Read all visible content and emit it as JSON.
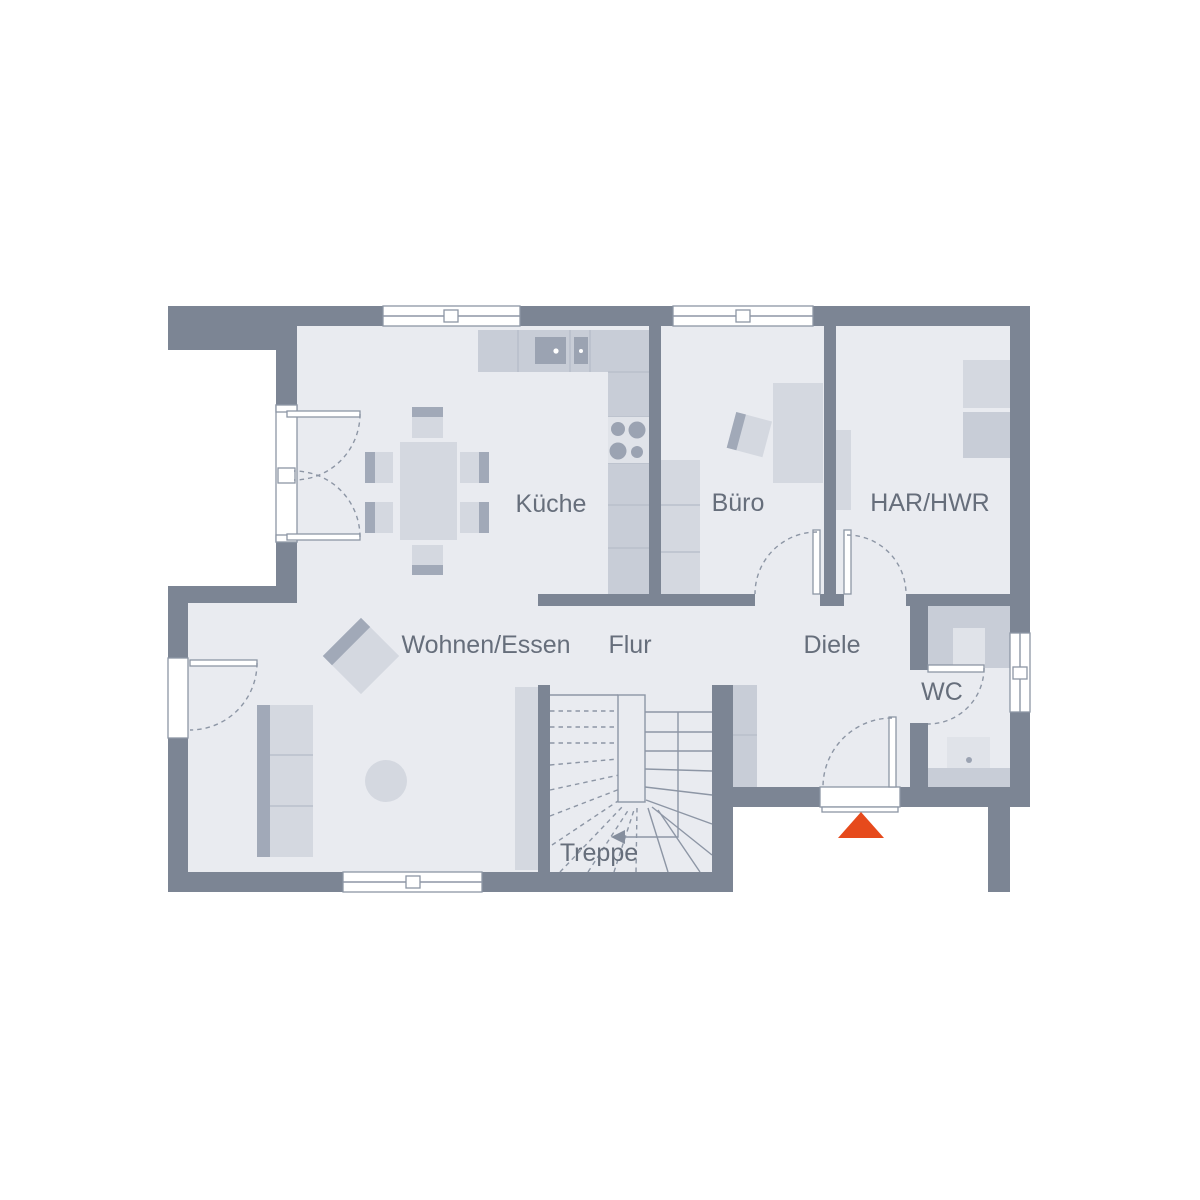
{
  "plan": {
    "type": "floor-plan",
    "rooms": [
      {
        "id": "kueche",
        "label": "Küche"
      },
      {
        "id": "buero",
        "label": "Büro"
      },
      {
        "id": "har_hwr",
        "label": "HAR/HWR"
      },
      {
        "id": "wohnen_essen",
        "label": "Wohnen/Essen"
      },
      {
        "id": "flur",
        "label": "Flur"
      },
      {
        "id": "diele",
        "label": "Diele"
      },
      {
        "id": "wc",
        "label": "WC"
      },
      {
        "id": "treppe",
        "label": "Treppe"
      }
    ],
    "colors": {
      "wall": "#7c8594",
      "floor": "#e9ebf0",
      "furniture_light": "#d4d8e0",
      "furniture_mid": "#c8cdd7",
      "furniture_dark": "#a1a9b8",
      "furniture_pale": "#e0e3e9",
      "appliance_dark": "#9ba3b2",
      "outline": "#8d96a5",
      "divider": "#b9c0cc",
      "label_text": "#666e7b",
      "entrance_marker": "#e64a1c",
      "background": "#ffffff"
    },
    "entrance_marker_shape": "triangle-up"
  }
}
